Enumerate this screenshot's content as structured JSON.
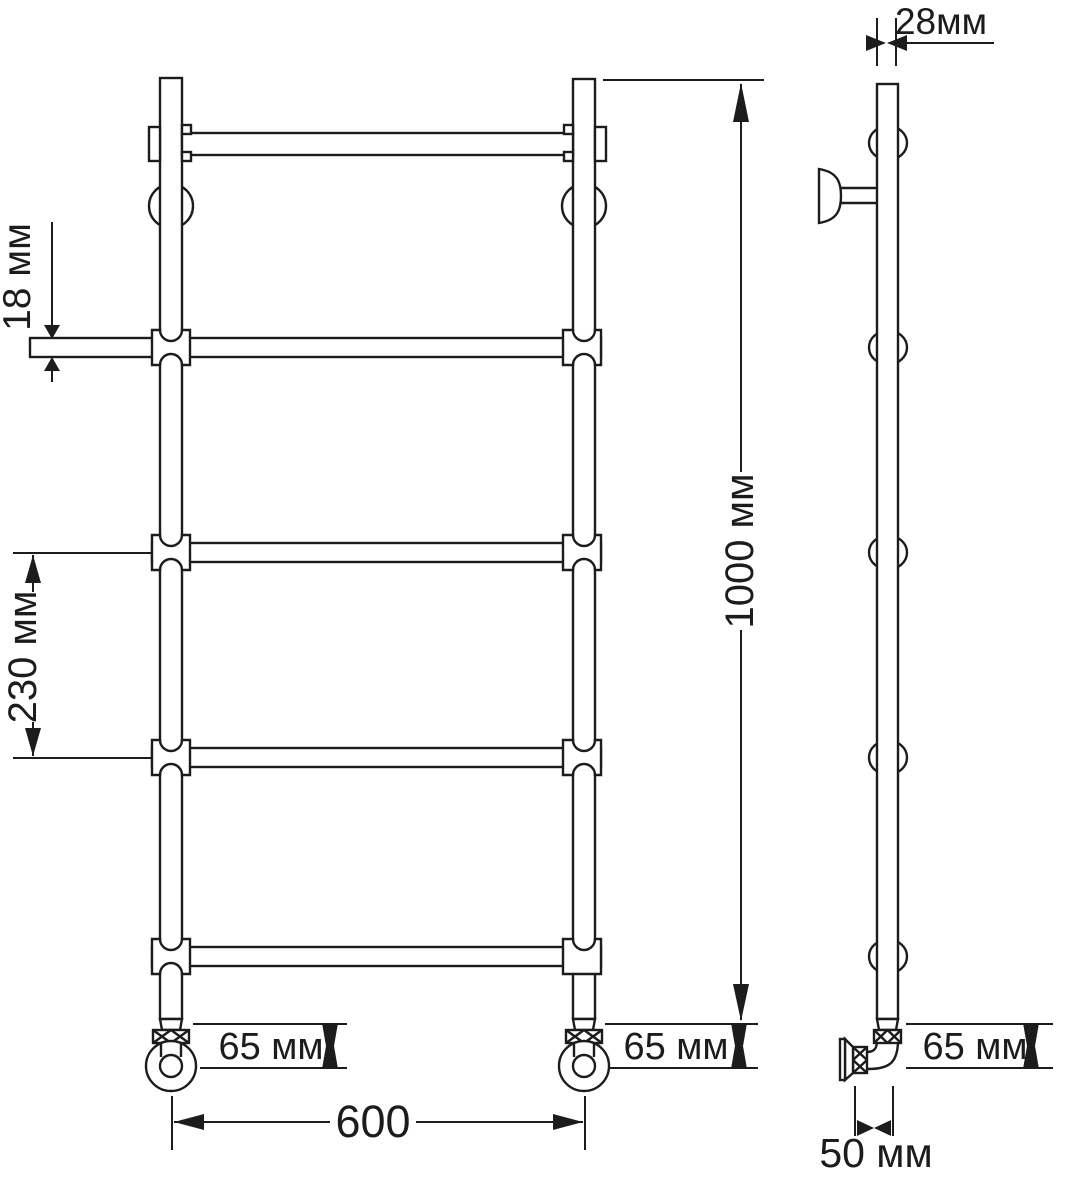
{
  "page": {
    "background": "#ffffff",
    "line_color": "#1c1c1c",
    "text_color": "#1c1c1c"
  },
  "drawing": {
    "dimensions": {
      "side_tube_diameter": "28мм",
      "rung_tube_diameter": "18 мм",
      "rung_spacing": "230 мм",
      "overall_height": "1000 мм",
      "foot_height_front_left": "65 мм",
      "foot_height_front_right": "65 мм",
      "foot_height_side": "65 мм",
      "overall_width": "600",
      "wall_offset": "50 мм"
    }
  }
}
